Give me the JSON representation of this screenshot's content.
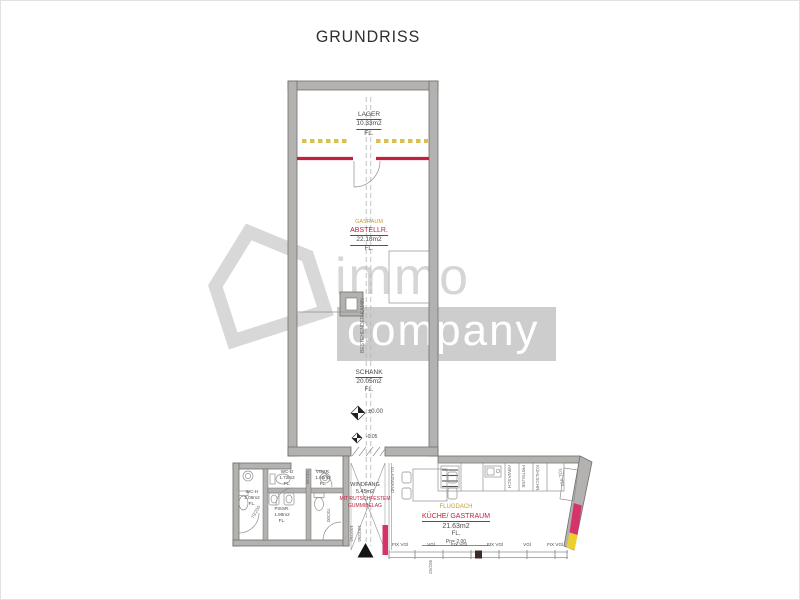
{
  "title": "GRUNDRISS",
  "watermark": {
    "brand_top": "immo",
    "brand_bottom": "company"
  },
  "colors": {
    "wall": "#b3b2b0",
    "accent_red": "#c32040",
    "accent_yellow": "#dcbf4e",
    "highlight_magenta": "#d6336c",
    "highlight_yellow": "#edd02c"
  },
  "rooms": {
    "lager": {
      "name": "LAGER",
      "area": "10.33m2",
      "floor": "FL."
    },
    "abstellraum": {
      "old_name": "GASRAUM",
      "name": "ABSTELLR.",
      "area": "22.18m2",
      "floor": "FL."
    },
    "schank": {
      "name": "SCHANK",
      "area": "20.05m2",
      "floor": "FL."
    },
    "windfang": {
      "name": "WINDFANG",
      "area": "5.45m2",
      "note_line1": "MIT RUTSCHFESTEM",
      "note_line2": "GUMMIBELAG"
    },
    "wc_h": {
      "name": "WC-H",
      "area": "2.06m2",
      "floor": "FL."
    },
    "wc_d": {
      "name": "WC-D",
      "area": "1.72m2",
      "floor": "FL."
    },
    "vorraum": {
      "name": "VORR.",
      "area": "1.60m2",
      "floor": "FL."
    },
    "pissoir": {
      "name": "PISSR.",
      "area": "1.98m2",
      "floor": "FL."
    },
    "kueche_gastraum": {
      "old_name": "FLUGDACH",
      "name": "KÜCHE/ GASTRAUM",
      "area": "21.63m2",
      "floor": "FL.",
      "height_note": "Pn= 2.00"
    }
  },
  "annotations": {
    "section_label": "BESTEHENDER KAMIN",
    "level_main": "±0.00",
    "level_entrance": "-0.05",
    "door_wc_h": "70/200",
    "door_wc_d": "70/190",
    "door_wc_b": "70/200",
    "entrance_door_1": "100/250",
    "entrance_door_2": "100/250",
    "glass_wall": "GLASWAND",
    "window_size": "25/205",
    "corner_window": "TGL.VGl",
    "kitchen_items": [
      "ABWASCH",
      "FRITEUSE",
      "KÜHLSCHR."
    ],
    "window_labels": [
      "FIX VGl",
      "VGl",
      "FIX VGl",
      "FIX VGl",
      "VGl",
      "FIX VGl"
    ]
  }
}
